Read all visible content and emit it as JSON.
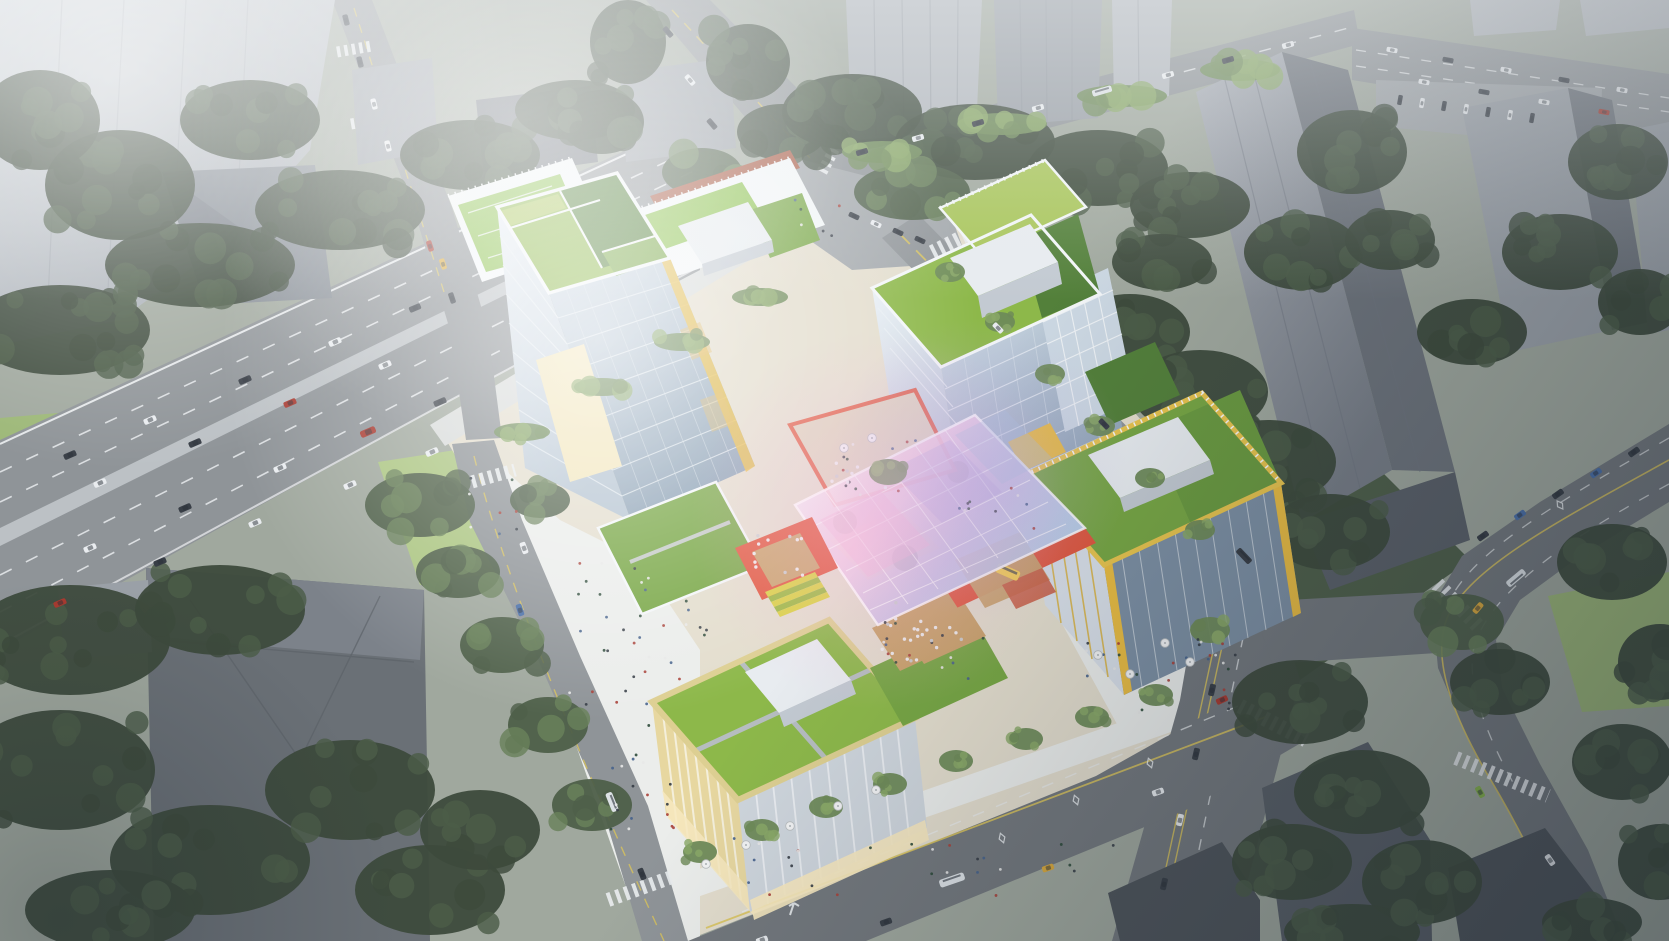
{
  "scene": {
    "type": "architectural-aerial-render",
    "elements": {
      "site": [
        "glass-office-tower-west",
        "glass-office-tower-center",
        "yellow-frame-office-east",
        "retail-podium-south",
        "rooftop-sports-annex",
        "iridescent-glass-canopy-plaza",
        "red-dining-terrace",
        "stepped-amphitheater",
        "green-roofs",
        "entrance-canopy"
      ],
      "context": [
        "hazy-highrise-towers",
        "residential-slabs",
        "hip-roof-building",
        "low-dark-buildings",
        "surface-parking-lot"
      ],
      "infrastructure": [
        "elevated-highway",
        "north-street",
        "east-avenue",
        "south-avenue",
        "west-street",
        "southeast-avenue",
        "crosswalks",
        "lane-markings",
        "street-trees",
        "sidewalk-cafes"
      ]
    }
  },
  "palette": {
    "base_ground": "#a0a89e",
    "haze_white": "#eef1f3",
    "tower_tl_light": "#c9ced3",
    "tower_tl_mid": "#a6acb3",
    "tower_tl_roof": "#868d95",
    "ctx_gray_light": "#b2b7bd",
    "ctx_gray_mid": "#9aa0a7",
    "ctx_gray_dark": "#6d737b",
    "ctx_gray_deep": "#5a6068",
    "bldg_dark": "#4e545a",
    "bldg_dark2": "#585e66",
    "bldg_lb": "#6a7076",
    "bldg_lb_top": "#7c828a",
    "tree_dark": "#3d4a3c",
    "tree_dark2": "#4c5d48",
    "tree_mid": "#4e5f49",
    "tree_mid2": "#69815a",
    "tree_bright": "#6e8a58",
    "tree_bright2": "#8aa868",
    "lawn": "#9db878",
    "lawn_bright": "#abc581",
    "road": "#8f9498",
    "road_dark": "#73787d",
    "road_light": "#a2a7ab",
    "median": "#bcc1c5",
    "lane_white": "#e9ecee",
    "lane_yellow": "#d9c35a",
    "sidewalk": "#d8dbda",
    "sidewalk_bright": "#ebedeb",
    "paving_warm": "#e3ddcd",
    "frame_white": "#f3f6f8",
    "mech_white": "#e8ecf0",
    "mech_side": "#c3cad2",
    "glass_light": "#ccd8e3",
    "glass_mid": "#9fb2c4",
    "glass_dark": "#7c8fa3",
    "roof_green_light": "#a9c65b",
    "roof_green": "#8db84a",
    "roof_green_mid": "#77a644",
    "roof_green_dark": "#53803a",
    "field_green": "#8cc24e",
    "track_red": "#a85a44",
    "gold": "#e9bc42",
    "gold_bright": "#f6cf4e",
    "cream": "#e7d7a0",
    "cream_light": "#f2e6bd",
    "terrace_red": "#e0553b",
    "deck_wood": "#c8a169",
    "glow_warm": "#f7e9c0",
    "canopy_white": "#f8fafc",
    "canopy_pink": "#f2c3e0",
    "canopy_violet": "#c5bce6",
    "canopy_blue": "#b5cde8",
    "car_white": "#e9ecef",
    "car_dark": "#383e46",
    "car_red": "#a83a30",
    "car_blue": "#4a6fa8",
    "car_taxi": "#d9a83c",
    "car_green": "#86b44a",
    "bus_white": "#dde2e6",
    "shadow": "#1d2733"
  },
  "people_colors": [
    "#353c45",
    "#a84038",
    "#e8e8e8",
    "#46628c",
    "#2e4a3a"
  ],
  "vehicles": [
    [
      70,
      455,
      -23,
      13,
      6,
      "car_dark"
    ],
    [
      150,
      420,
      -23,
      13,
      6,
      "car_white"
    ],
    [
      245,
      380,
      -23,
      13,
      6,
      "car_dark"
    ],
    [
      335,
      342,
      -23,
      13,
      6,
      "car_white"
    ],
    [
      415,
      308,
      -23,
      12,
      6,
      "car_dark"
    ],
    [
      100,
      483,
      -23,
      13,
      6,
      "car_white"
    ],
    [
      195,
      443,
      -23,
      13,
      6,
      "car_dark"
    ],
    [
      290,
      403,
      -23,
      13,
      6,
      "car_red"
    ],
    [
      385,
      365,
      -23,
      13,
      6,
      "car_white"
    ],
    [
      90,
      548,
      -23,
      13,
      6,
      "car_white"
    ],
    [
      185,
      508,
      -23,
      13,
      6,
      "car_dark"
    ],
    [
      280,
      468,
      -23,
      13,
      6,
      "car_white"
    ],
    [
      368,
      432,
      -23,
      16,
      7,
      "car_red"
    ],
    [
      440,
      402,
      -23,
      13,
      6,
      "car_dark"
    ],
    [
      60,
      603,
      -23,
      13,
      6,
      "car_red"
    ],
    [
      160,
      562,
      -23,
      13,
      6,
      "car_dark"
    ],
    [
      255,
      523,
      -23,
      13,
      6,
      "car_white"
    ],
    [
      350,
      485,
      -23,
      13,
      6,
      "car_white"
    ],
    [
      432,
      452,
      -23,
      13,
      6,
      "car_white"
    ],
    [
      862,
      152,
      -16,
      12,
      5.5,
      "car_dark"
    ],
    [
      918,
      138,
      -16,
      12,
      5.5,
      "car_white"
    ],
    [
      978,
      123,
      -16,
      12,
      5.5,
      "car_dark"
    ],
    [
      1038,
      108,
      -16,
      12,
      5.5,
      "car_white"
    ],
    [
      1102,
      91,
      -16,
      20,
      6.5,
      "bus_white"
    ],
    [
      1168,
      75,
      -16,
      12,
      5.5,
      "car_white"
    ],
    [
      1228,
      60,
      -16,
      12,
      5.5,
      "car_dark"
    ],
    [
      1288,
      45,
      -16,
      12,
      5.5,
      "car_white"
    ],
    [
      1392,
      50,
      10,
      11,
      5,
      "car_white"
    ],
    [
      1448,
      60,
      10,
      11,
      5,
      "car_dark"
    ],
    [
      1506,
      70,
      10,
      11,
      5,
      "car_white"
    ],
    [
      1564,
      80,
      10,
      11,
      5,
      "car_dark"
    ],
    [
      1622,
      90,
      10,
      11,
      5,
      "car_white"
    ],
    [
      1424,
      82,
      10,
      11,
      5,
      "car_white"
    ],
    [
      1484,
      92,
      10,
      11,
      5,
      "car_dark"
    ],
    [
      1544,
      102,
      10,
      11,
      5,
      "car_white"
    ],
    [
      1604,
      112,
      10,
      11,
      5,
      "car_red"
    ],
    [
      1400,
      100,
      100,
      10,
      4.5,
      "car_dark"
    ],
    [
      1422,
      103,
      100,
      10,
      4.5,
      "car_white"
    ],
    [
      1444,
      106,
      100,
      10,
      4.5,
      "car_dark"
    ],
    [
      1466,
      109,
      100,
      10,
      4.5,
      "car_white"
    ],
    [
      1488,
      112,
      100,
      10,
      4.5,
      "car_dark"
    ],
    [
      1510,
      115,
      100,
      10,
      4.5,
      "car_white"
    ],
    [
      1532,
      118,
      100,
      10,
      4.5,
      "car_dark"
    ],
    [
      668,
      32,
      49,
      12,
      5.5,
      "car_dark"
    ],
    [
      690,
      80,
      49,
      12,
      5.5,
      "car_white"
    ],
    [
      712,
      124,
      49,
      12,
      5.5,
      "car_dark"
    ],
    [
      854,
      216,
      25,
      11,
      5,
      "car_dark"
    ],
    [
      876,
      224,
      25,
      11,
      5,
      "car_white"
    ],
    [
      898,
      232,
      25,
      11,
      5,
      "car_dark"
    ],
    [
      920,
      240,
      25,
      11,
      5,
      "car_dark"
    ],
    [
      998,
      328,
      46,
      12,
      5.5,
      "car_white"
    ],
    [
      1104,
      424,
      46,
      12,
      5.5,
      "car_dark"
    ],
    [
      1244,
      556,
      46,
      18,
      6.5,
      "car_dark"
    ],
    [
      1212,
      690,
      103,
      12,
      6,
      "car_dark"
    ],
    [
      1196,
      754,
      103,
      12,
      6,
      "car_dark"
    ],
    [
      1180,
      820,
      103,
      12,
      6,
      "car_white"
    ],
    [
      1164,
      884,
      103,
      12,
      6,
      "car_dark"
    ],
    [
      1634,
      452,
      145,
      12,
      6,
      "car_dark"
    ],
    [
      1596,
      473,
      145,
      12,
      6,
      "car_blue"
    ],
    [
      1558,
      494,
      145,
      12,
      6,
      "car_dark"
    ],
    [
      1520,
      515,
      145,
      12,
      6,
      "car_blue"
    ],
    [
      1483,
      536,
      145,
      12,
      6,
      "car_dark"
    ],
    [
      1516,
      578,
      140,
      22,
      7,
      "bus_white"
    ],
    [
      1478,
      608,
      130,
      12,
      6,
      "car_taxi"
    ],
    [
      1480,
      792,
      60,
      12,
      6,
      "car_green"
    ],
    [
      1550,
      860,
      55,
      12,
      6,
      "car_white"
    ],
    [
      524,
      548,
      70,
      12,
      6,
      "car_white"
    ],
    [
      520,
      610,
      72,
      12,
      6,
      "car_blue"
    ],
    [
      612,
      802,
      68,
      20,
      7,
      "bus_white"
    ],
    [
      642,
      874,
      68,
      12,
      6,
      "car_dark"
    ],
    [
      346,
      20,
      76,
      11,
      5.5,
      "car_dark"
    ],
    [
      360,
      62,
      76,
      11,
      5.5,
      "car_dark"
    ],
    [
      374,
      104,
      76,
      11,
      5.5,
      "car_white"
    ],
    [
      388,
      146,
      76,
      11,
      5.5,
      "car_white"
    ],
    [
      430,
      246,
      72,
      11,
      5.5,
      "car_red"
    ],
    [
      443,
      264,
      72,
      11,
      5.5,
      "car_taxi"
    ],
    [
      452,
      298,
      72,
      11,
      5.5,
      "car_dark"
    ],
    [
      952,
      880,
      -19,
      26,
      8,
      "bus_white"
    ],
    [
      1048,
      868,
      -19,
      12,
      6,
      "car_taxi"
    ],
    [
      886,
      922,
      -19,
      12,
      6,
      "car_dark"
    ],
    [
      1158,
      792,
      -19,
      12,
      6,
      "car_white"
    ],
    [
      1222,
      700,
      -25,
      12,
      6,
      "car_red"
    ],
    [
      762,
      940,
      -19,
      12,
      6,
      "car_white"
    ]
  ],
  "tree_clusters": [
    [
      60,
      330,
      90,
      45,
      14,
      "dark"
    ],
    [
      200,
      265,
      95,
      42,
      13,
      "dark"
    ],
    [
      340,
      210,
      85,
      40,
      12,
      "dark"
    ],
    [
      470,
      155,
      70,
      35,
      10,
      "dark"
    ],
    [
      575,
      110,
      60,
      30,
      9,
      "dark"
    ],
    [
      120,
      185,
      75,
      55,
      10,
      "dark"
    ],
    [
      40,
      120,
      60,
      50,
      8,
      "dark"
    ],
    [
      250,
      120,
      70,
      40,
      8,
      "dark"
    ],
    [
      70,
      640,
      100,
      55,
      12,
      "dark"
    ],
    [
      220,
      610,
      85,
      45,
      10,
      "dark"
    ],
    [
      60,
      770,
      95,
      60,
      10,
      "dark"
    ],
    [
      210,
      860,
      100,
      55,
      10,
      "dark"
    ],
    [
      350,
      790,
      85,
      50,
      9,
      "dark"
    ],
    [
      430,
      890,
      75,
      45,
      8,
      "dark"
    ],
    [
      110,
      910,
      85,
      40,
      8,
      "dark"
    ],
    [
      480,
      830,
      60,
      40,
      7,
      "dark"
    ],
    [
      420,
      505,
      55,
      32,
      8,
      "mid"
    ],
    [
      458,
      572,
      42,
      26,
      6,
      "mid"
    ],
    [
      502,
      645,
      42,
      28,
      6,
      "mid"
    ],
    [
      548,
      725,
      40,
      28,
      6,
      "mid"
    ],
    [
      592,
      805,
      40,
      26,
      6,
      "mid"
    ],
    [
      628,
      42,
      38,
      42,
      7,
      "dark"
    ],
    [
      602,
      122,
      42,
      32,
      6,
      "dark"
    ],
    [
      748,
      62,
      42,
      38,
      7,
      "dark"
    ],
    [
      782,
      132,
      45,
      28,
      6,
      "dark"
    ],
    [
      702,
      172,
      40,
      24,
      5,
      "mid"
    ],
    [
      852,
      112,
      70,
      38,
      9,
      "dark"
    ],
    [
      975,
      142,
      80,
      38,
      10,
      "dark"
    ],
    [
      1098,
      168,
      70,
      38,
      9,
      "dark"
    ],
    [
      1190,
      205,
      60,
      33,
      8,
      "dark"
    ],
    [
      912,
      192,
      58,
      28,
      7,
      "mid"
    ],
    [
      882,
      152,
      40,
      11,
      6,
      "bright"
    ],
    [
      1002,
      124,
      45,
      11,
      6,
      "bright"
    ],
    [
      1122,
      96,
      45,
      11,
      6,
      "bright"
    ],
    [
      1240,
      70,
      40,
      11,
      6,
      "bright"
    ],
    [
      1130,
      332,
      60,
      38,
      8,
      "dark"
    ],
    [
      1200,
      392,
      68,
      42,
      9,
      "dark"
    ],
    [
      1268,
      462,
      68,
      42,
      9,
      "dark"
    ],
    [
      1330,
      532,
      60,
      38,
      8,
      "dark"
    ],
    [
      1162,
      262,
      50,
      28,
      6,
      "dark"
    ],
    [
      1352,
      152,
      55,
      42,
      8,
      "dark"
    ],
    [
      1302,
      252,
      58,
      38,
      8,
      "dark"
    ],
    [
      1618,
      162,
      50,
      38,
      7,
      "dark"
    ],
    [
      1560,
      252,
      58,
      38,
      8,
      "dark"
    ],
    [
      1472,
      332,
      55,
      33,
      7,
      "dark"
    ],
    [
      1640,
      302,
      42,
      33,
      6,
      "dark"
    ],
    [
      1390,
      240,
      45,
      30,
      6,
      "dark"
    ],
    [
      1300,
      702,
      68,
      42,
      9,
      "dark"
    ],
    [
      1362,
      792,
      68,
      42,
      9,
      "dark"
    ],
    [
      1292,
      862,
      60,
      38,
      8,
      "dark"
    ],
    [
      1422,
      882,
      60,
      42,
      8,
      "dark"
    ],
    [
      1352,
      932,
      68,
      28,
      7,
      "dark"
    ],
    [
      1500,
      682,
      50,
      33,
      7,
      "dark"
    ],
    [
      1462,
      622,
      42,
      28,
      6,
      "mid"
    ],
    [
      1612,
      562,
      55,
      38,
      7,
      "dark"
    ],
    [
      1660,
      662,
      42,
      38,
      6,
      "dark"
    ],
    [
      1622,
      762,
      50,
      38,
      7,
      "dark"
    ],
    [
      1660,
      862,
      42,
      38,
      6,
      "dark"
    ],
    [
      1592,
      922,
      50,
      24,
      6,
      "dark"
    ],
    [
      700,
      852,
      17,
      11,
      4,
      "bright"
    ],
    [
      762,
      830,
      17,
      11,
      4,
      "bright"
    ],
    [
      826,
      807,
      17,
      11,
      4,
      "bright"
    ],
    [
      890,
      784,
      17,
      11,
      4,
      "bright"
    ],
    [
      956,
      761,
      17,
      11,
      4,
      "bright"
    ],
    [
      1026,
      739,
      17,
      11,
      4,
      "bright"
    ],
    [
      1092,
      717,
      17,
      11,
      4,
      "bright"
    ],
    [
      1156,
      695,
      17,
      11,
      4,
      "bright"
    ],
    [
      950,
      272,
      15,
      10,
      4,
      "bright"
    ],
    [
      1000,
      322,
      15,
      10,
      4,
      "bright"
    ],
    [
      1050,
      374,
      15,
      10,
      4,
      "bright"
    ],
    [
      1100,
      426,
      15,
      10,
      4,
      "bright"
    ],
    [
      1150,
      478,
      15,
      10,
      4,
      "bright"
    ],
    [
      1200,
      530,
      15,
      10,
      4,
      "bright"
    ],
    [
      855,
      450,
      26,
      17,
      5,
      "mid"
    ],
    [
      1012,
      568,
      24,
      16,
      5,
      "mid"
    ],
    [
      888,
      472,
      19,
      13,
      4,
      "bright"
    ],
    [
      522,
      432,
      28,
      9,
      4,
      "bright"
    ],
    [
      602,
      387,
      28,
      9,
      4,
      "bright"
    ],
    [
      682,
      342,
      28,
      9,
      4,
      "bright"
    ],
    [
      760,
      297,
      28,
      9,
      4,
      "bright"
    ],
    [
      540,
      500,
      30,
      18,
      5,
      "mid"
    ],
    [
      1210,
      630,
      20,
      13,
      4,
      "bright"
    ]
  ],
  "people_areas": [
    [
      560,
      560,
      90,
      150,
      26
    ],
    [
      610,
      720,
      70,
      120,
      18
    ],
    [
      660,
      600,
      50,
      80,
      10
    ],
    [
      868,
      618,
      120,
      62,
      16
    ],
    [
      1085,
      638,
      150,
      75,
      18
    ],
    [
      700,
      838,
      430,
      58,
      26
    ],
    [
      795,
      198,
      80,
      40,
      6
    ],
    [
      468,
      478,
      55,
      60,
      8
    ],
    [
      948,
      478,
      86,
      60,
      10
    ],
    [
      820,
      440,
      100,
      55,
      12
    ],
    [
      1190,
      642,
      60,
      50,
      8
    ]
  ],
  "umbrellas": [
    [
      706,
      864
    ],
    [
      746,
      845
    ],
    [
      790,
      826
    ],
    [
      838,
      806
    ],
    [
      876,
      790
    ],
    [
      1098,
      655
    ],
    [
      1130,
      674
    ],
    [
      1165,
      643
    ],
    [
      1190,
      662
    ],
    [
      844,
      448
    ],
    [
      872,
      438
    ]
  ],
  "table_areas": [
    [
      752,
      534,
      55,
      44,
      12
    ],
    [
      876,
      602,
      74,
      52,
      14
    ],
    [
      906,
      624,
      56,
      40,
      9
    ],
    [
      828,
      452,
      70,
      40,
      8
    ]
  ],
  "diamond_markings": [
    [
      1002,
      838,
      -19
    ],
    [
      1076,
      800,
      -19
    ],
    [
      1150,
      763,
      -19
    ],
    [
      1560,
      505,
      -35
    ]
  ]
}
